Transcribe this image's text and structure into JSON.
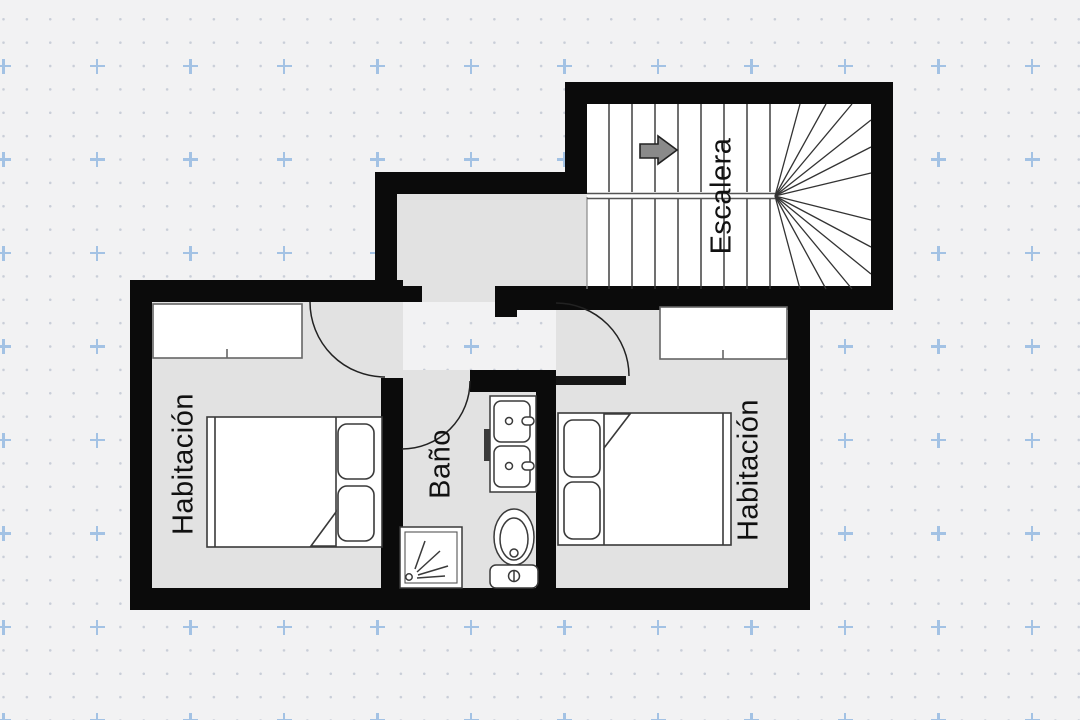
{
  "plan": {
    "rooms": {
      "bedroom_left": {
        "label": "Habitación"
      },
      "bedroom_right": {
        "label": "Habitación"
      },
      "bathroom": {
        "label": "Baño"
      },
      "staircase": {
        "label": "Escalera"
      }
    },
    "icons": {
      "stair_direction_arrow": "right-arrow",
      "fixtures": [
        "double-sink",
        "toilet",
        "shower"
      ]
    },
    "palette": {
      "wall": "#0b0b0b",
      "room_fill": "#e2e2e2",
      "stair_fill": "#ffffff",
      "line": "#3a3a3a",
      "grid_dot": "#c9ced8",
      "grid_plus": "#a3c2e4",
      "background": "#f2f2f3"
    }
  }
}
